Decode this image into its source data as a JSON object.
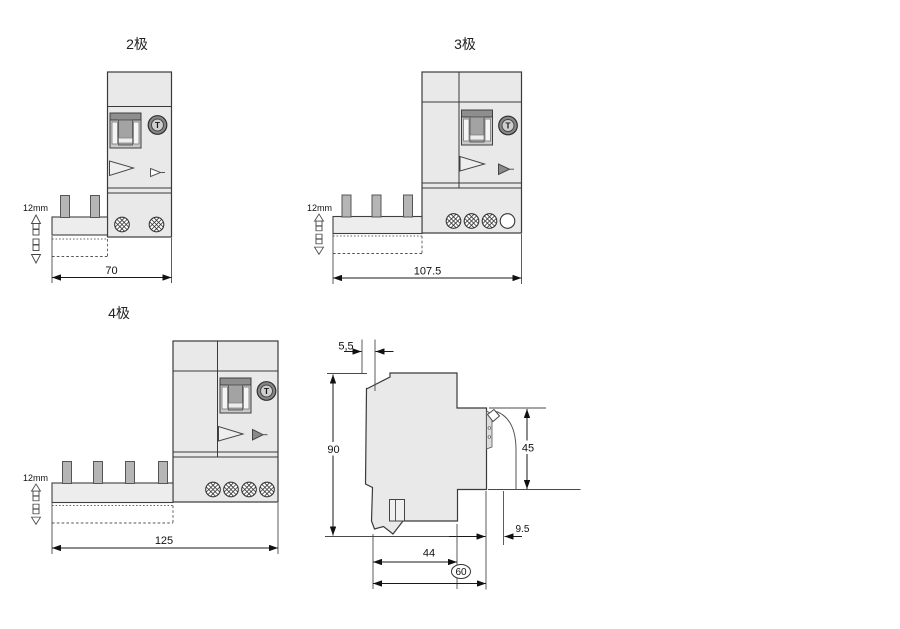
{
  "colors": {
    "background": "#ffffff",
    "body_fill": "#e9e9e9",
    "line": "#1a1a1a",
    "pin_fill": "#b5b5b5"
  },
  "shared": {
    "test_button_label": "T"
  },
  "drawings": {
    "pole2": {
      "title": "2极",
      "width_dim": "70",
      "busbar_pitch": "12mm"
    },
    "pole3": {
      "title": "3极",
      "width_dim": "107.5",
      "busbar_pitch": "12mm"
    },
    "pole4": {
      "title": "4极",
      "width_dim": "125",
      "busbar_pitch": "12mm"
    },
    "side_view": {
      "front_lip_dim": "5,5",
      "height_dim": "90",
      "front_height_dim": "45",
      "rear_offset_dim": "9.5",
      "depth_dim": "44",
      "total_depth_dim": "60"
    }
  }
}
